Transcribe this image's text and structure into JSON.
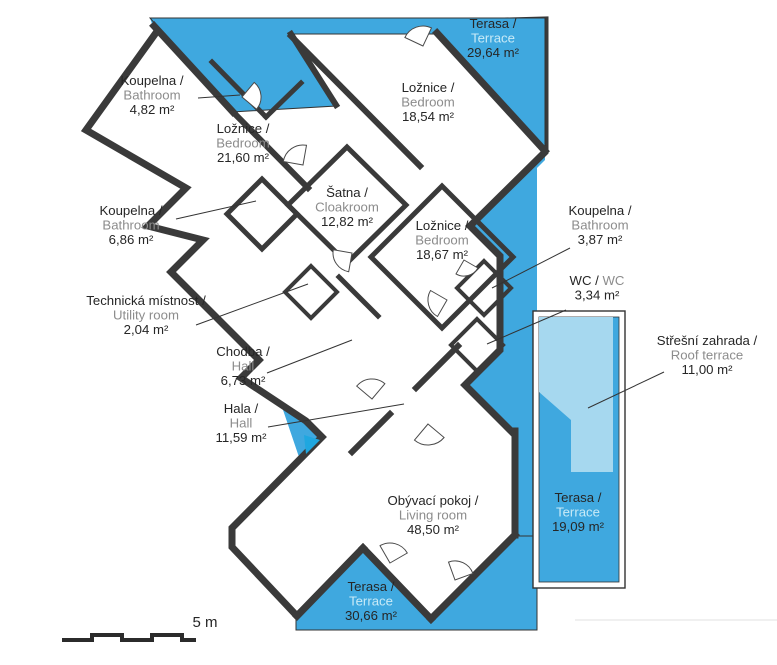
{
  "plan": {
    "type": "apartment-floor-plan",
    "colors": {
      "terrace_blue": "#3fa8df",
      "roof_garden_light_blue": "#a6d8ef",
      "wall_dark": "#3a3a3a",
      "text_dark": "#262626",
      "text_gray": "#8c8c8c",
      "text_light": "#c8eaf7",
      "entrance_arrow": "#1fa7e0"
    },
    "scale": {
      "label": "5 m"
    },
    "rooms": [
      {
        "id": "terrace-top",
        "cz": "Terasa /",
        "en": "Terrace",
        "area": "29,64 m²",
        "x": 493,
        "y": 28,
        "en_style": "light"
      },
      {
        "id": "bathroom-482",
        "cz": "Koupelna /",
        "en": "Bathroom",
        "area": "4,82 m²",
        "x": 152,
        "y": 85,
        "en_style": "gray"
      },
      {
        "id": "bedroom-1854",
        "cz": "Ložnice /",
        "en": "Bedroom",
        "area": "18,54 m²",
        "x": 428,
        "y": 92,
        "en_style": "gray"
      },
      {
        "id": "bedroom-2160",
        "cz": "Ložnice /",
        "en": "Bedroom",
        "area": "21,60 m²",
        "x": 243,
        "y": 133,
        "en_style": "gray"
      },
      {
        "id": "cloakroom-1282",
        "cz": "Šatna /",
        "en": "Cloakroom",
        "area": "12,82 m²",
        "x": 347,
        "y": 197,
        "en_style": "gray"
      },
      {
        "id": "bathroom-686",
        "cz": "Koupelna /",
        "en": "Bathroom",
        "area": "6,86 m²",
        "x": 131,
        "y": 215,
        "en_style": "gray"
      },
      {
        "id": "bathroom-387",
        "cz": "Koupelna /",
        "en": "Bathroom",
        "area": "3,87 m²",
        "x": 600,
        "y": 215,
        "en_style": "gray"
      },
      {
        "id": "bedroom-1867",
        "cz": "Ložnice /",
        "en": "Bedroom",
        "area": "18,67 m²",
        "x": 442,
        "y": 230,
        "en_style": "gray"
      },
      {
        "id": "wc-334",
        "cz": "WC / ",
        "en": "WC",
        "area": "3,34 m²",
        "x": 597,
        "y": 285,
        "en_style": "gray",
        "inline": true
      },
      {
        "id": "utility-204",
        "cz": "Technická místnost /",
        "en": "Utility room",
        "area": "2,04 m²",
        "x": 146,
        "y": 305,
        "en_style": "gray"
      },
      {
        "id": "roof-terrace",
        "cz": "Střešní zahrada /",
        "en": "Roof terrace",
        "area": "11,00 m²",
        "x": 707,
        "y": 345,
        "en_style": "gray"
      },
      {
        "id": "corridor-673",
        "cz": "Chodba /",
        "en": "Hall",
        "area": "6,73 m²",
        "x": 243,
        "y": 356,
        "en_style": "gray"
      },
      {
        "id": "hall-1159",
        "cz": "Hala /",
        "en": "Hall",
        "area": "11,59 m²",
        "x": 241,
        "y": 413,
        "en_style": "gray"
      },
      {
        "id": "living-room",
        "cz": "Obývací pokoj /",
        "en": "Living room",
        "area": "48,50 m²",
        "x": 433,
        "y": 505,
        "en_style": "gray"
      },
      {
        "id": "terrace-right",
        "cz": "Terasa /",
        "en": "Terrace",
        "area": "19,09 m²",
        "x": 578,
        "y": 502,
        "en_style": "light"
      },
      {
        "id": "terrace-bottom",
        "cz": "Terasa /",
        "en": "Terrace",
        "area": "30,66 m²",
        "x": 371,
        "y": 591,
        "en_style": "light"
      }
    ]
  }
}
